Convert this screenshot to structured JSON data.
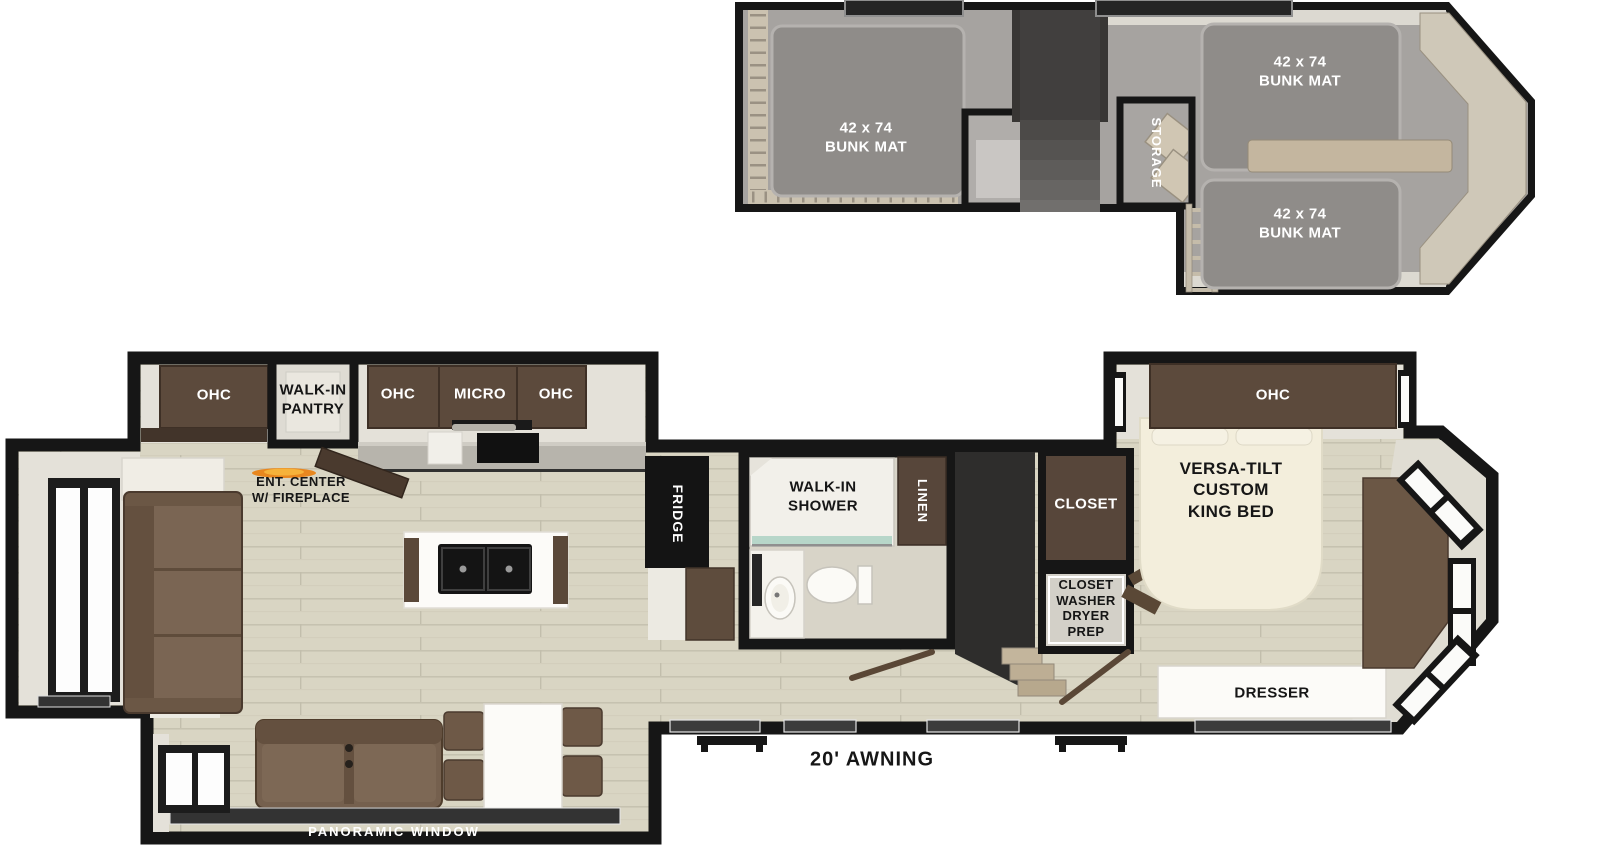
{
  "colors": {
    "wall": "#161616",
    "wood_floor": "#d9d5c3",
    "loft_carpet": "#a6a3a0",
    "bunk_mat": "#8f8c89",
    "cabinet_brown": "#5c4a3c",
    "closet_brown": "#57463a",
    "sofa_brown": "#75604e",
    "cream_wall": "#e4e1d9",
    "fixture_white": "#fcfbf8",
    "fireplace_flame": "#e8871f",
    "shower_glass_teal": "#b7d6c9"
  },
  "loft": {
    "bunk_left": {
      "size": "42 x 74",
      "name": "BUNK MAT"
    },
    "bunk_top_right": {
      "size": "42 x 74",
      "name": "BUNK MAT"
    },
    "bunk_bottom_right": {
      "size": "42 x 74",
      "name": "BUNK MAT"
    },
    "storage": "STORAGE"
  },
  "main": {
    "living": {
      "ohc": "OHC",
      "pantry": {
        "line1": "WALK-IN",
        "line2": "PANTRY"
      },
      "ent_center": {
        "line1": "ENT. CENTER",
        "line2": "W/ FIREPLACE"
      },
      "panoramic_window": "PANORAMIC WINDOW"
    },
    "kitchen": {
      "ohc_left": "OHC",
      "micro": "MICRO",
      "ohc_right": "OHC",
      "fridge": "FRIDGE"
    },
    "bathroom": {
      "shower": {
        "line1": "WALK-IN",
        "line2": "SHOWER"
      },
      "linen": "LINEN"
    },
    "bedroom": {
      "ohc": "OHC",
      "closet": "CLOSET",
      "washer_closet": {
        "line1": "CLOSET",
        "line2": "WASHER",
        "line3": "DRYER",
        "line4": "PREP"
      },
      "bed": {
        "line1": "VERSA-TILT",
        "line2": "CUSTOM",
        "line3": "KING BED"
      },
      "dresser": "DRESSER"
    },
    "exterior": {
      "awning": "20' AWNING"
    }
  }
}
